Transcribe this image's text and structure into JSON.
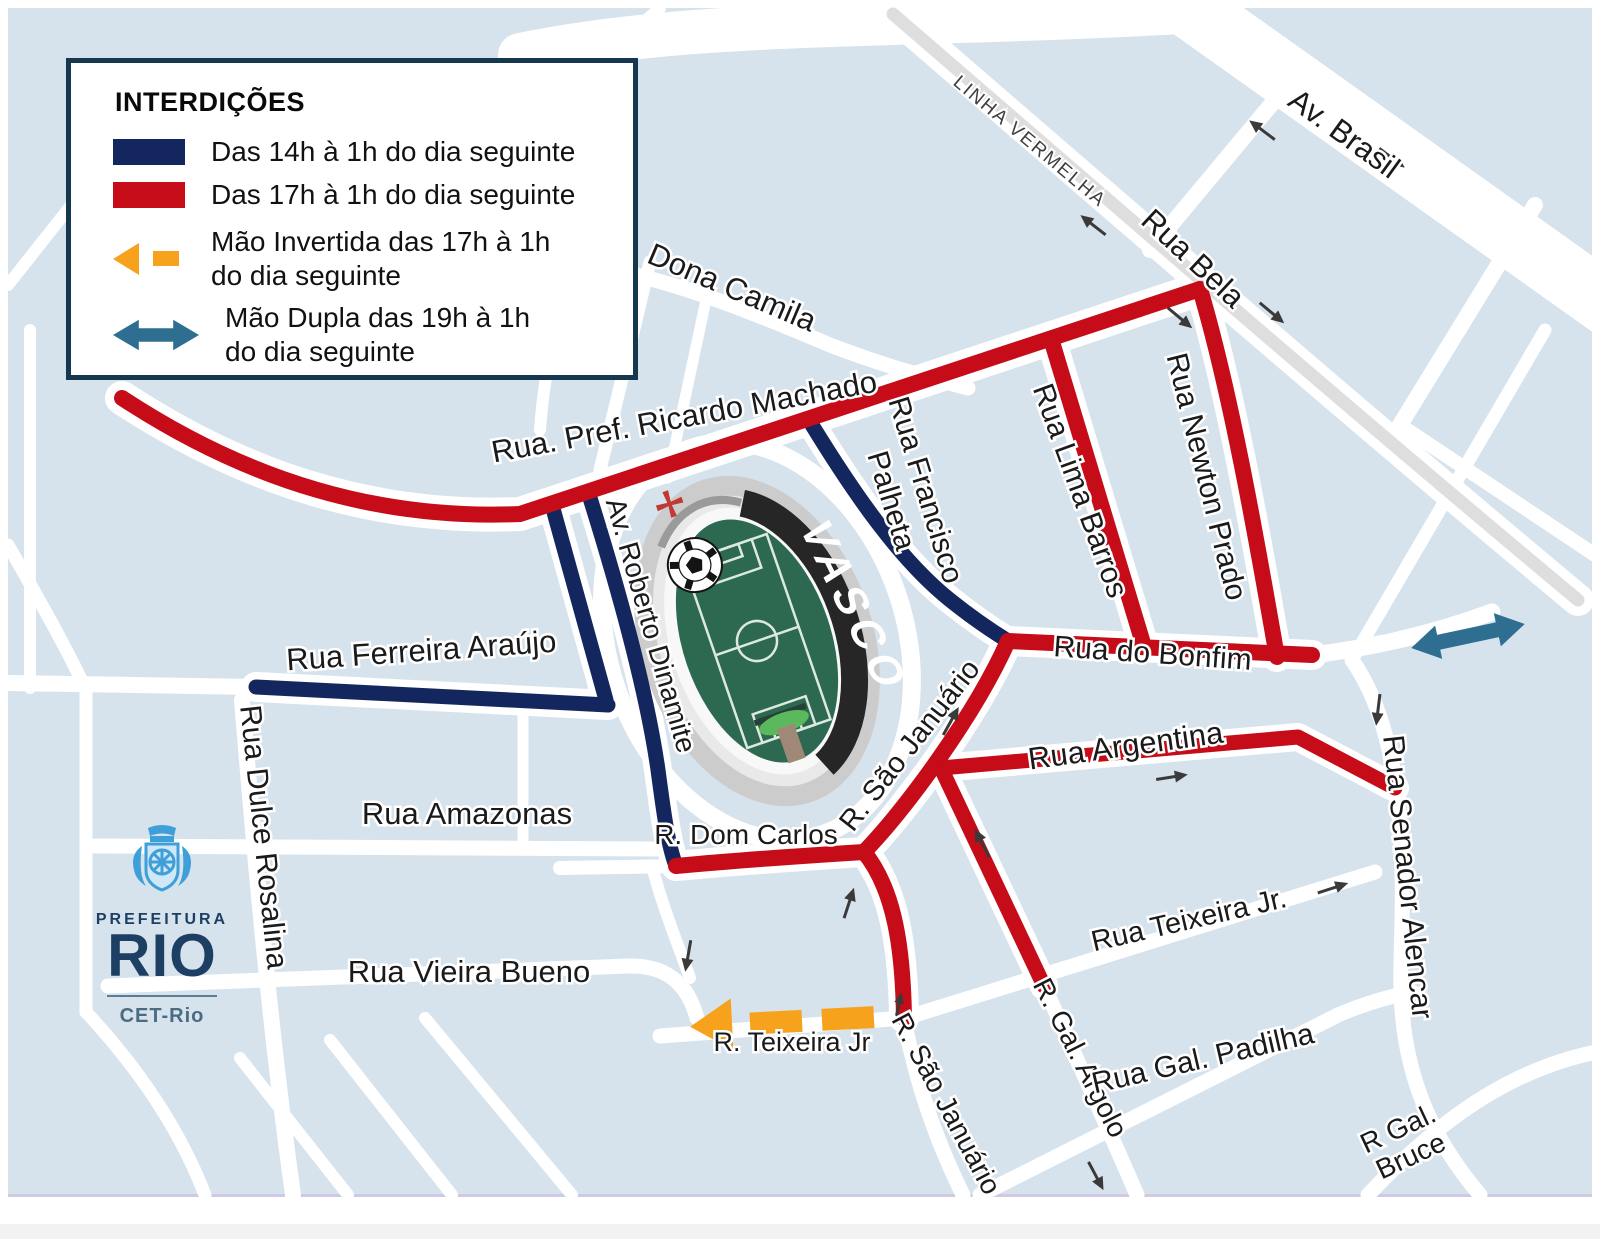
{
  "colors": {
    "navy": "#14265e",
    "red": "#c60c18",
    "orange": "#f7a21c",
    "teal": "#2d6e91",
    "map-bg": "#d6e3ed",
    "label": "#1a1a1a",
    "legend-border": "#16384f",
    "logo-navy": "#1d3f63",
    "logo-blue": "#3f9fd8",
    "highway-gray": "#dedede",
    "footer-gray": "#f2f2f4"
  },
  "legend": {
    "title": "INTERDIÇÕES",
    "items": [
      {
        "type": "swatch-navy",
        "label_line1": "Das 14h à 1h do dia seguinte",
        "label_line2": ""
      },
      {
        "type": "swatch-red",
        "label_line1": "Das 17h à 1h do dia seguinte",
        "label_line2": ""
      },
      {
        "type": "arrow-orange",
        "label_line1": "Mão Invertida das 17h à 1h",
        "label_line2": "do dia seguinte"
      },
      {
        "type": "arrow-teal",
        "label_line1": "Mão Dupla das 19h à 1h",
        "label_line2": "do dia seguinte"
      }
    ]
  },
  "logo": {
    "prefeitura": "PREFEITURA",
    "rio": "RIO",
    "department": "CET-Rio"
  },
  "stadium": {
    "club": "VASCO"
  },
  "streets": {
    "linha_vermelha": "LINHA VERMELHA",
    "av_brasil": "Av. Brasil",
    "rua_bela": "Rua Bela",
    "dona_camila": "Dona Camila",
    "ricardo_machado": "Rua. Pref. Ricardo Machado",
    "francisco_palheta_1": "Rua Francisco",
    "francisco_palheta_2": "Palheta",
    "lima_barros": "Rua Lima Barros",
    "newton_prado": "Rua Newton Prado",
    "do_bonfim": "Rua do Bonfim",
    "ferreira_araujo": "Rua Ferreira Araújo",
    "roberto_dinamite": "Av. Roberto Dinamite",
    "dulce_rosalina": "Rua Dulce Rosalina",
    "amazonas": "Rua Amazonas",
    "dom_carlos": "R. Dom Carlos",
    "sao_januario_upper": "R. São Januário",
    "argentina": "Rua Argentina",
    "senador_alencar": "Rua Senador Alencar",
    "teixeira_jr_upper": "Rua Teixeira Jr.",
    "vieira_bueno": "Rua Vieira Bueno",
    "teixeira_jr_lower": "R.  Teixeira Jr",
    "sao_januario_lower": "R.  São Januário",
    "gal_argolo": "R. Gal. Argolo",
    "gal_padilha": "Rua Gal. Padilha",
    "gal_bruce_1": "R Gal.",
    "gal_bruce_2": "Bruce"
  }
}
